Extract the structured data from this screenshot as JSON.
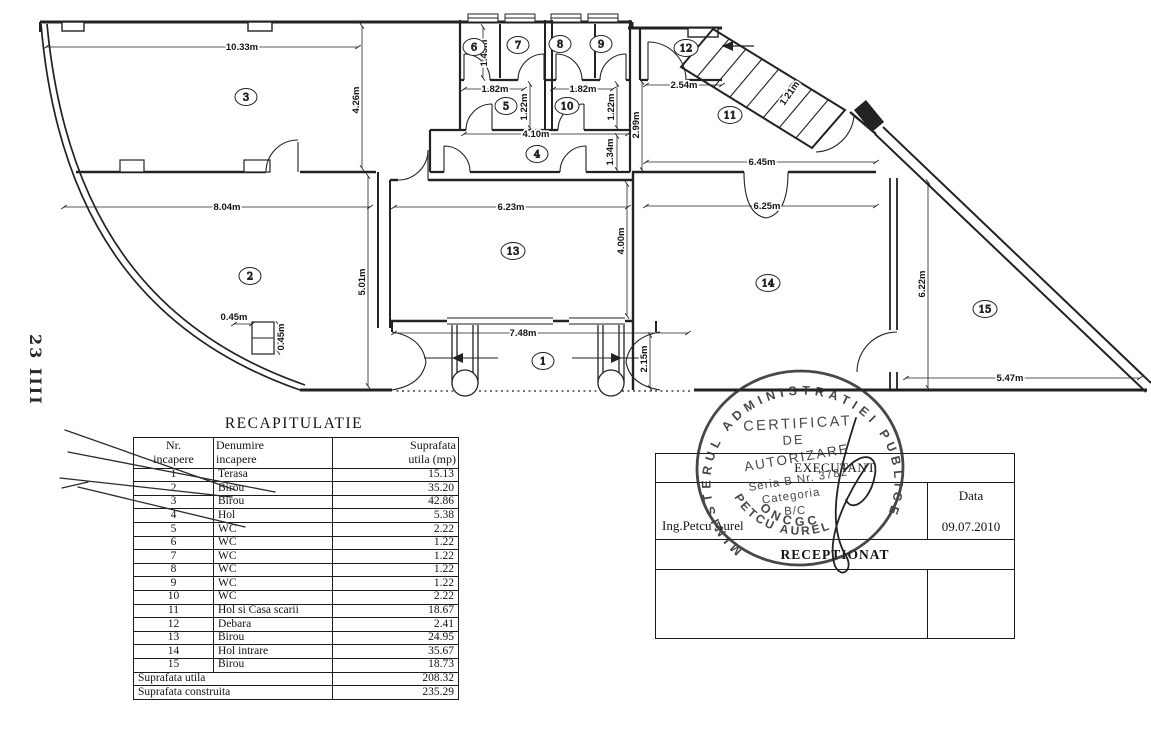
{
  "page": {
    "background": "#ffffff",
    "ink": "#222222"
  },
  "plan": {
    "side_note": "23 IIII",
    "rooms": {
      "r1": "1",
      "r2": "2",
      "r3": "3",
      "r4": "4",
      "r5": "5",
      "r6": "6",
      "r7": "7",
      "r8": "8",
      "r9": "9",
      "r10": "10",
      "r11": "11",
      "r12": "12",
      "r13": "13",
      "r14": "14",
      "r15": "15"
    },
    "dims": {
      "room3_width": "10.33m",
      "room3_height": "4.26m",
      "room2_width": "8.04m",
      "room2_height": "5.01m",
      "column_w": "0.45m",
      "column_h": "0.45m",
      "room13_width": "6.23m",
      "room13_height": "4.00m",
      "terrace_width": "7.48m",
      "terrace_depth": "2.15m",
      "wc_top_height": "1.45m",
      "wc_pair1_width": "1.82m",
      "wc_pair2_width": "1.82m",
      "wc5_height": "1.22m",
      "wc10_height": "1.22m",
      "hall4_width": "4.10m",
      "hall4_height": "1.34m",
      "room11_height": "2.99m",
      "room12_width": "2.54m",
      "stair_width": "1.21m",
      "room11_width": "6.45m",
      "room14_width": "6.25m",
      "room15_height": "6.22m",
      "room15_width": "5.47m"
    }
  },
  "recap": {
    "title": "RECAPITULATIE",
    "header_col1": "Nr.\nincapere",
    "header_col2": "Denumire\nincapere",
    "header_col3": "Suprafata\nutila (mp)",
    "rows": [
      [
        "1",
        "Terasa",
        "15.13"
      ],
      [
        "2",
        "Birou",
        "35.20"
      ],
      [
        "3",
        "Birou",
        "42.86"
      ],
      [
        "4",
        "Hol",
        "5.38"
      ],
      [
        "5",
        "WC",
        "2.22"
      ],
      [
        "6",
        "WC",
        "1.22"
      ],
      [
        "7",
        "WC",
        "1.22"
      ],
      [
        "8",
        "WC",
        "1.22"
      ],
      [
        "9",
        "WC",
        "1.22"
      ],
      [
        "10",
        "WC",
        "2.22"
      ],
      [
        "11",
        "Hol si Casa scarii",
        "18.67"
      ],
      [
        "12",
        "Debara",
        "2.41"
      ],
      [
        "13",
        "Birou",
        "24.95"
      ],
      [
        "14",
        "Hol intrare",
        "35.67"
      ],
      [
        "15",
        "Birou",
        "18.73"
      ]
    ],
    "total_util_label": "Suprafata utila",
    "total_util_value": "208.32",
    "total_constr_label": "Suprafata construita",
    "total_constr_value": "235.29"
  },
  "titleblock": {
    "executant_label": "EXECUTANT",
    "engineer": "Ing.Petcu Aurel",
    "data_label": "Data",
    "date": "09.07.2010",
    "receptionat_label": "RECEPTIONAT"
  },
  "stamp": {
    "ring_text": "MINISTERUL ADMINISTRATIEI PUBLICE",
    "line1": "CERTIFICAT",
    "line2": "DE",
    "line3": "AUTORIZARE",
    "line4": "Seria B Nr. 3782",
    "line5": "Categoria",
    "line6": "B/C",
    "bottom1": "PETCU AUREL",
    "bottom2": "ONCGC"
  }
}
